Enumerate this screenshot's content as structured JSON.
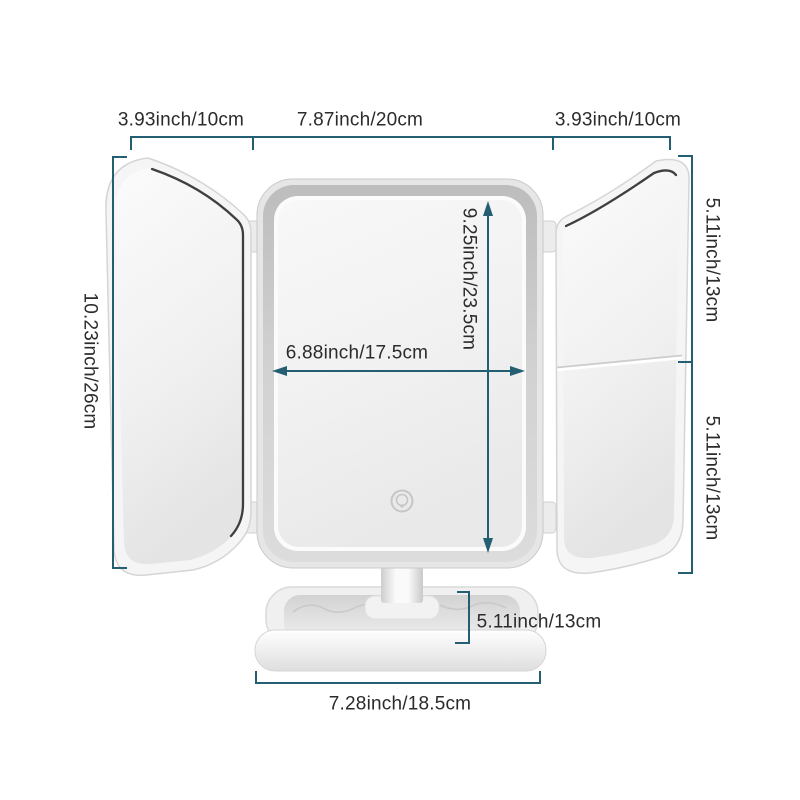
{
  "diagram": {
    "subject": "Trifold LED vanity mirror with storage base - dimension diagram",
    "colors": {
      "dimension_line": "#235e72",
      "label_text": "#2b2b2b",
      "background": "#ffffff",
      "frame_gray": "#c6c6c6"
    },
    "icons": [
      {
        "name": "touch-sensor-icon"
      }
    ]
  },
  "dimensions": {
    "left_panel_width": "3.93inch/10cm",
    "center_panel_width": "7.87inch/20cm",
    "right_panel_width": "3.93inch/10cm",
    "overall_height": "10.23inch/26cm",
    "right_top_mirror_height": "5.11inch/13cm",
    "right_bottom_mirror_height": "5.11inch/13cm",
    "glass_height": "9.25inch/23.5cm",
    "glass_width": "6.88inch/17.5cm",
    "base_depth": "5.11inch/13cm",
    "base_width": "7.28inch/18.5cm"
  }
}
